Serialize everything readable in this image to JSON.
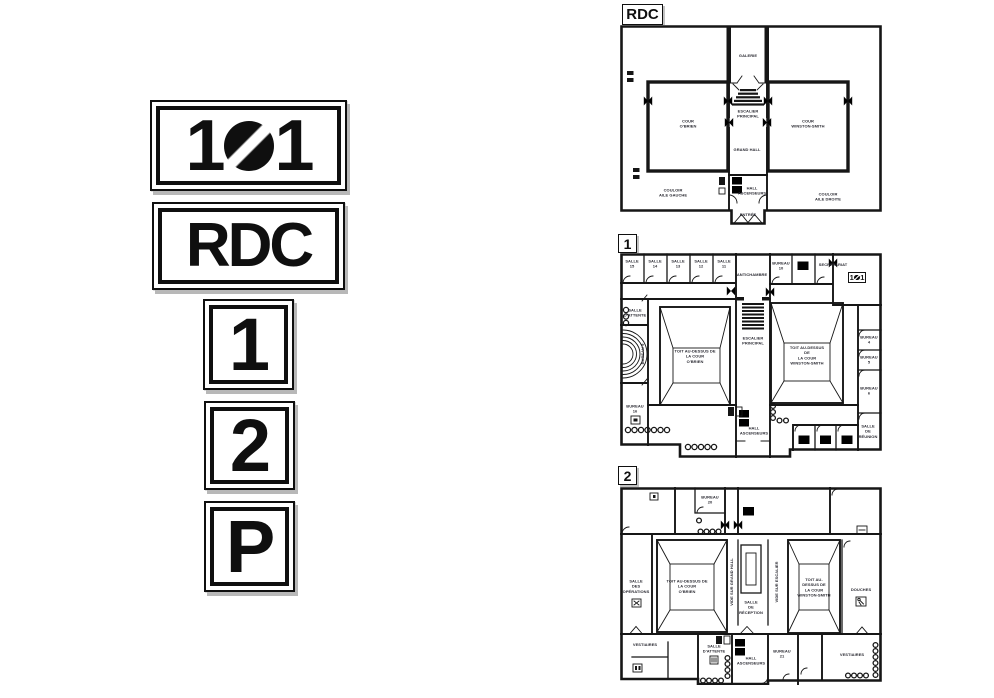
{
  "signs": {
    "s101": {
      "left": "1",
      "right": "1",
      "zero_icon": "slashed-zero-disc"
    },
    "rdc": "RDC",
    "floor1": "1",
    "floor2": "2",
    "parking": "P"
  },
  "plans": {
    "rdc": {
      "tag": "RDC",
      "rooms": {
        "galerie": "GALERIE",
        "escalier": "ESCALIER\nPRINCIPAL",
        "cour_gauche": "COUR\nO'BRIEN",
        "cour_droite": "COUR\nWINSTON-SMITH",
        "grand_hall": "GRAND HALL",
        "hall_ascenseurs": "HALL\nASCENSEURS",
        "entree": "ENTRÉE",
        "couloir_gauche": "COULOIR\nAILE GAUCHE",
        "couloir_droite": "COULOIR\nAILE DROITE"
      }
    },
    "f1": {
      "tag": "1",
      "rooms": {
        "salle15": "SALLE\n15",
        "salle14": "SALLE\n14",
        "salle13": "SALLE\n13",
        "salle12": "SALLE\n12",
        "salle11": "SALLE\n11",
        "antichambre": "ANTICHAMBRE",
        "bureau10": "BUREAU\n10",
        "secretariat": "SECRÉTARIAT",
        "room101": {
          "left": "1",
          "right": "1",
          "zero_icon": "slashed-zero-disc"
        },
        "salle_attente": "SALLE\nD'ATTENTE",
        "bureau9": "BUREAU 9",
        "bureau16": "BUREAU\n16",
        "toit_obrien": "TOIT AU-DESSUS DE\nLA COUR\nO'BRIEN",
        "escalier": "ESCALIER\nPRINCIPAL",
        "toit_winston": "TOIT AU-DESSUS DE\nLA COUR\nWINSTON-SMITH",
        "bureau4": "BUREAU 4",
        "bureau5": "BUREAU 5",
        "bureau6": "BUREAU 6",
        "salle_reunion": "SALLE\nDE\nRÉUNION",
        "hall_ascenseurs": "HALL\nASCENSEURS"
      }
    },
    "f2": {
      "tag": "2",
      "rooms": {
        "bureau20": "BUREAU\n20",
        "salle_operations": "SALLE\nDES\nOPÉRATIONS",
        "toit_obrien": "TOIT AU-DESSUS DE\nLA COUR\nO'BRIEN",
        "vide_hall": "VIDE SUR GRAND HALL",
        "salle_reception": "SALLE\nDE\nRÉCEPTION",
        "vide_escalier": "VIDE SUR ESCALIER",
        "toit_winston": "TOIT AU-DESSUS DE\nLA COUR\nWINSTON-SMITH",
        "douches": "DOUCHES",
        "vestiaires_gauche": "VESTIAIRES",
        "salle_attente": "SALLE\nD'ATTENTE",
        "hall_ascenseurs": "HALL\nASCENSEURS",
        "bureau21": "BUREAU\n21",
        "vestiaires_droite": "VESTIAIRES"
      }
    }
  },
  "icons": {
    "slashed_zero": "slashed-zero-disc",
    "elevator": "elevator-icon",
    "toilet": "toilet-icon",
    "double_entry_door": "double-door-icon",
    "door_swing": "door-swing-arc-icon",
    "door_passage": "door-passage-chevron-icon",
    "radiator": "radiator-icon",
    "seats": "seat-circle-icon",
    "stairs": "stairs-icon",
    "shower": "shower-icon",
    "coat_hooks": "coat-hook-icon",
    "phone": "phone-icon"
  },
  "colors": {
    "ink": "#161616",
    "paper": "#ffffff",
    "shadow": "#b8b8b8"
  }
}
